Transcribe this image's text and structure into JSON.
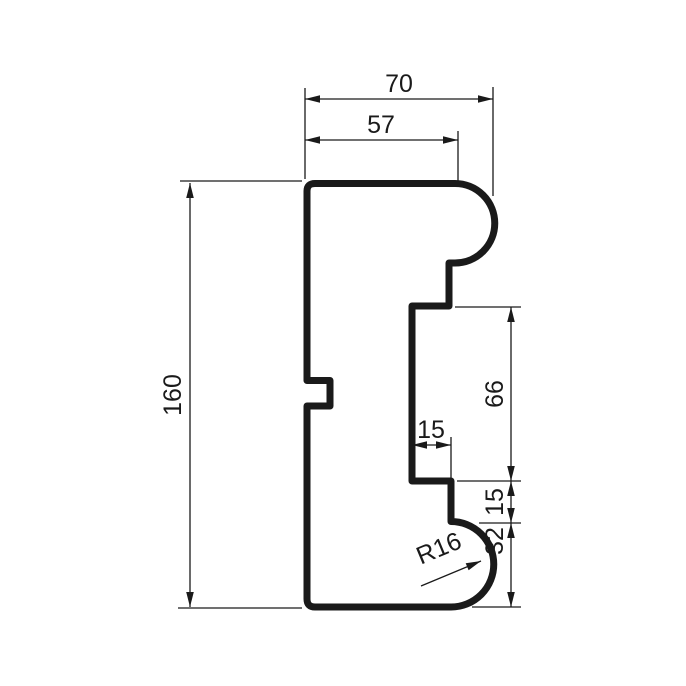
{
  "drawing": {
    "title": "Molding profile cross-section drawing",
    "background_color": "#ffffff",
    "line_color": "#1a1a1a",
    "canvas": {
      "width": 686,
      "height": 686
    },
    "profile": {
      "name": "molding-profile-outline",
      "stroke_width": 7,
      "path": "M 307 191 Q 307 183.5 315 183.5 L 455 183.5 A 39.75 39.75 0 0 1 455 263 L 449 263 L 449 306 L 412 306 L 412 481 L 451 481 L 451 521.5 A 42.75 42.75 0 0 1 451 607 L 315 607 Q 307 607 307 599 L 307 406 L 330 406 L 330 380.5 L 307 380.5 Z"
    },
    "dimension_style": {
      "thin_stroke_width": 1.3,
      "font_size": 25,
      "arrow_length": 15,
      "arrow_half_width": 3.8
    },
    "dimensions": [
      {
        "id": "dim-70",
        "label": "70",
        "orientation": "horizontal",
        "y": 99,
        "x1": 305,
        "x2": 493,
        "text_x": 399,
        "text_y": 92
      },
      {
        "id": "dim-57",
        "label": "57",
        "orientation": "horizontal",
        "y": 140,
        "x1": 305,
        "x2": 458,
        "text_x": 381,
        "text_y": 133
      },
      {
        "id": "dim-160",
        "label": "160",
        "orientation": "vertical",
        "x": 190,
        "y1": 183,
        "y2": 607,
        "text_x": 181,
        "text_y": 395
      },
      {
        "id": "dim-66",
        "label": "66",
        "orientation": "vertical",
        "x": 511,
        "y1": 307,
        "y2": 481,
        "text_x": 503,
        "text_y": 394
      },
      {
        "id": "dim-15-width",
        "label": "15",
        "orientation": "horizontal",
        "y": 445,
        "x1": 412,
        "x2": 451,
        "text_x": 431,
        "text_y": 438
      },
      {
        "id": "dim-15-height",
        "label": "15",
        "orientation": "vertical",
        "x": 511,
        "y1": 481,
        "y2": 523,
        "text_x": 503,
        "text_y": 502
      },
      {
        "id": "dim-32",
        "label": "32",
        "orientation": "vertical",
        "x": 511,
        "y1": 523,
        "y2": 607,
        "text_x": 503,
        "text_y": 541
      }
    ],
    "radius_callout": {
      "id": "dim-r16",
      "label": "R16",
      "leader": {
        "x1": 421,
        "y1": 586,
        "x2": 481,
        "y2": 561
      },
      "text_x": 442,
      "text_y": 556,
      "text_angle": -22.5
    },
    "extension_lines": [
      {
        "x1": 305,
        "y1": 88,
        "x2": 305,
        "y2": 179
      },
      {
        "x1": 493,
        "y1": 87,
        "x2": 493,
        "y2": 196
      },
      {
        "x1": 458,
        "y1": 131,
        "x2": 458,
        "y2": 181
      },
      {
        "x1": 180,
        "y1": 181,
        "x2": 302,
        "y2": 181
      },
      {
        "x1": 178,
        "y1": 608,
        "x2": 302,
        "y2": 608
      },
      {
        "x1": 455,
        "y1": 307,
        "x2": 521,
        "y2": 307
      },
      {
        "x1": 457,
        "y1": 481,
        "x2": 521,
        "y2": 481
      },
      {
        "x1": 479,
        "y1": 523,
        "x2": 521,
        "y2": 523
      },
      {
        "x1": 472,
        "y1": 607,
        "x2": 521,
        "y2": 607
      },
      {
        "x1": 451,
        "y1": 437,
        "x2": 451,
        "y2": 478
      }
    ]
  }
}
